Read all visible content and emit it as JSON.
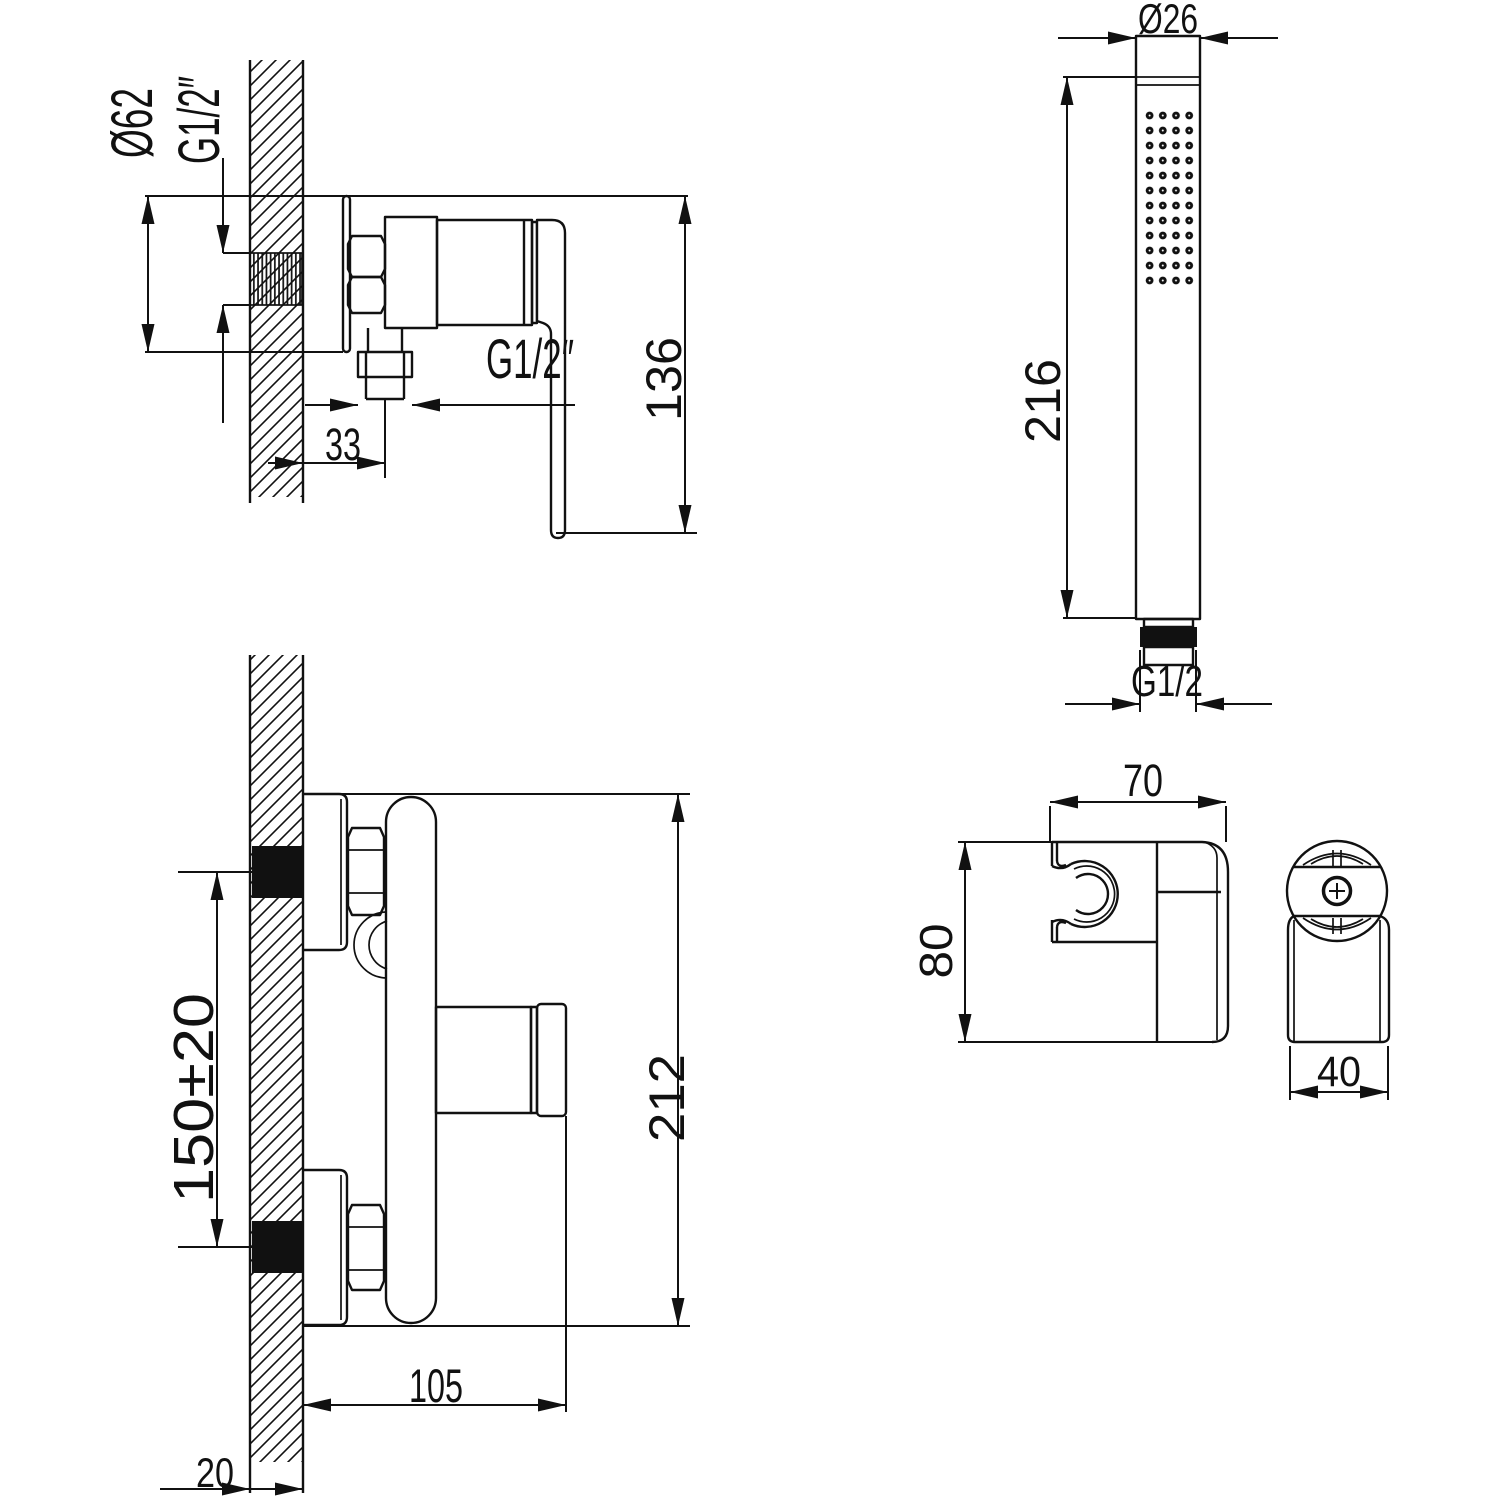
{
  "style": {
    "line_color": "#111111",
    "background": "#ffffff"
  },
  "views": {
    "mixer_side": {
      "name": "shower mixer wall-mount side view",
      "dims": {
        "flange_dia": "Ø62",
        "inlet_thread": "G1/2″",
        "outlet_thread": "G1/2″",
        "outlet_offset": "33",
        "height": "136"
      }
    },
    "hand_shower": {
      "name": "hand shower stick view",
      "dims": {
        "head_dia": "Ø26",
        "length": "216",
        "thread": "G1/2"
      }
    },
    "mixer_front": {
      "name": "shower mixer front view",
      "dims": {
        "inlet_spacing": "150±20",
        "height": "212",
        "width": "105",
        "wall_thickness": "20"
      }
    },
    "holder_side": {
      "name": "shower holder side view",
      "dims": {
        "depth": "70",
        "height": "80"
      }
    },
    "holder_front": {
      "name": "shower holder front view",
      "dims": {
        "width": "40"
      }
    }
  }
}
